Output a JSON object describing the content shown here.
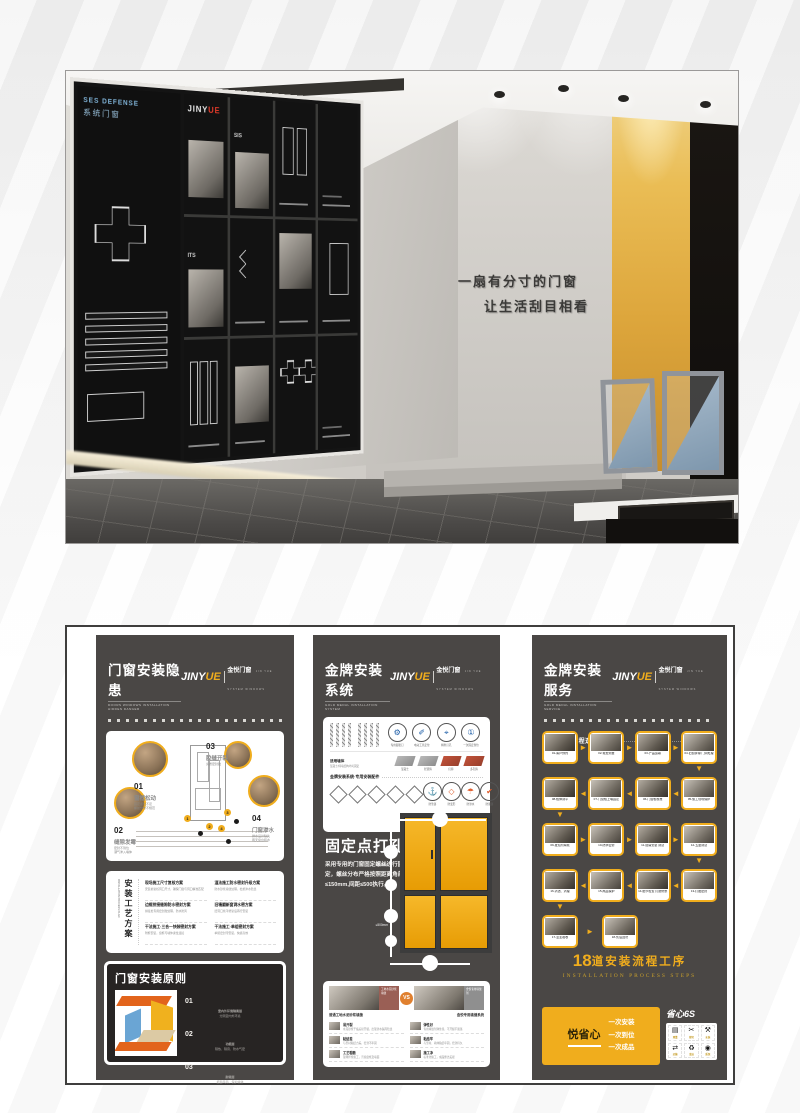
{
  "brand": {
    "logo_main": "JINY",
    "logo_accent": "UE",
    "logo_cn": "金悦门窗",
    "logo_en": "JIN YUE SYSTEM WINDOWS"
  },
  "scene": {
    "slogan_line1": "一扇有分寸的门窗",
    "slogan_line2": "让生活刮目相看",
    "board_tag_en": "SES DEFENSE",
    "board_tag_cn": "系统门窗",
    "board_logo": "JINY",
    "board_logo_accent": "UE",
    "board_cell1": "SIS",
    "board_cell2": "ITS"
  },
  "p1": {
    "title": "门窗安装隐患",
    "subtitle": "DOORS WINDOWS INSTALLATION HIDDEN DANGER",
    "section1": "门窗常见安装痛点",
    "pains": [
      {
        "num": "01",
        "label": "窗框松动",
        "d1": "固定点位不足",
        "d2": "螺丝分布不规范",
        "d3": "久用易晃动变形"
      },
      {
        "num": "02",
        "label": "缝隙发霉",
        "d1": "密封不到位",
        "d2": "潮气渗入墙体",
        "d3": "窗边霉变发黑"
      },
      {
        "num": "03",
        "label": "胶缝开裂",
        "d1": "劣质密封胶",
        "d2": "干缩开裂脱落",
        "d3": "漏风又渗水"
      },
      {
        "num": "04",
        "label": "门窗渗水",
        "d1": "排水设计缺失",
        "d2": "雨天窗台积水",
        "d3": "墙面返潮起皮"
      }
    ],
    "plan_title": "安装工艺方案",
    "plan_title_en": "INSTALLATION PROCESS PLAN",
    "plans": [
      {
        "h": "现场施工尺寸复核方案",
        "d": "安装前复核洞口尺寸，确保门窗与洞口精准匹配"
      },
      {
        "h": "湿法施工防水密封升级方案",
        "d": "防水砂浆塞缝处理，杜绝渗水隐患"
      },
      {
        "h": "边框拼接缝隙防水密封方案",
        "d": "拼接处专用密封胶处理，防水防风"
      },
      {
        "h": "旧墙翻新窗洞水密方案",
        "d": "旧洞口找平修复后再行安装"
      },
      {
        "h": "干法施工·三合一快装密封方案",
        "d": "附框安装，窗框与墙体柔性连接"
      },
      {
        "h": "干法施工·单组密封方案",
        "d": "单组密封带安装，快捷高效"
      }
    ],
    "principle_title": "门窗安装原则",
    "principles": [
      {
        "num": "01",
        "h": "室内外环境隔离层",
        "d": "分隔室内外环境"
      },
      {
        "num": "02",
        "h": "功能层",
        "d": "隔热、隔音、防水气密"
      },
      {
        "num": "03",
        "h": "耐候层",
        "d": "抵御风雨、保护墙体"
      }
    ]
  },
  "p2": {
    "title": "金牌安装系统",
    "subtitle": "GOLD MEDAL INSTALLATION SYSTEM",
    "section1": "金牌安装系统-膨胀钉",
    "anchor_tag": "膨胀钉规格",
    "anchor_note": "产品配套专用安装螺丝组合",
    "icons1": [
      "专用膨胀钉",
      "电动工具定位",
      "精准打孔",
      "一次固定到位"
    ],
    "walls_tag": "适用墙体",
    "walls_note": "混凝土/砖墙结构均可固定",
    "walls": [
      "混凝土",
      "轻质砖",
      "红砖",
      "多孔砖"
    ],
    "section1b": "金牌安装系统·专用安装配件",
    "icons2": [
      "防坠落",
      "防变形",
      "防渗水",
      "防脱落"
    ],
    "drill_title": "固定点打孔",
    "drill_desc": "采用专用的门窗固定螺丝进行固定，螺丝分布严格按照距离角部≤150mm,间距≤500执行。",
    "dim1": "≤150mm",
    "dim2": "≤500mm",
    "section2": "金牌安装系统-填缝剂",
    "vs": "VS",
    "vs_left_tag": "工地水泥砂浆填缝",
    "vs_right_tag": "金悦专用填缝剂",
    "vs_left_caption": "普通工地水泥砂浆填缝",
    "vs_right_caption": "金悦专用填缝系统",
    "vs_left_items": [
      {
        "h": "易开裂",
        "d": "水泥砂浆干缩后易开裂，出现渗水漏风隐患"
      },
      {
        "h": "粘结差",
        "d": "与型材粘结力差，密封不牢固"
      },
      {
        "h": "工艺粗糙",
        "d": "现场拌浆施工，污染窗框及墙面"
      }
    ],
    "vs_right_items": [
      {
        "h": "弹性好",
        "d": "专用填缝剂弹性佳，不开裂不脱落"
      },
      {
        "h": "粘结牢",
        "d": "与型材、墙体粘结牢固，密封持久"
      },
      {
        "h": "施工净",
        "d": "标准化施工，成品整洁美观"
      }
    ]
  },
  "p3": {
    "title": "金牌安装服务",
    "subtitle": "GOLD MEDAL INSTALLATION SERVICE",
    "section1": "精心服务 流程透明",
    "steps": [
      "01-客户预约",
      "02-免费测量",
      "03-产品运输",
      "04-旧窗拆除 门洞处理",
      "05-施工现场保护",
      "06-门窗框校准",
      "07-门窗框上墙固定",
      "08-框体调平",
      "09-发泡剂填充",
      "10-防水密封",
      "11-窗扇安装 调试",
      "12-五金调试",
      "13-打胶密封",
      "14-细节检查 打磨修整",
      "15-成品保护",
      "16-清洁、清理",
      "17-业主验收",
      "18-售后回访"
    ],
    "steps_num": "18",
    "steps_title": "道安装流程工序",
    "steps_sub": "INSTALLATION PROCESS STEPS",
    "promise_title": "悦省心",
    "promise1": "一次安装",
    "promise2": "一次到位",
    "promise3": "一次成品",
    "six_title": "省心6S",
    "six_labels": [
      "测量",
      "裁切",
      "安装",
      "运输",
      "清洁",
      "质保"
    ]
  },
  "colors": {
    "accent_yellow": "#f0ad1d",
    "poster_bg": "#4a4745",
    "wall_yellow": "#dda63c"
  }
}
